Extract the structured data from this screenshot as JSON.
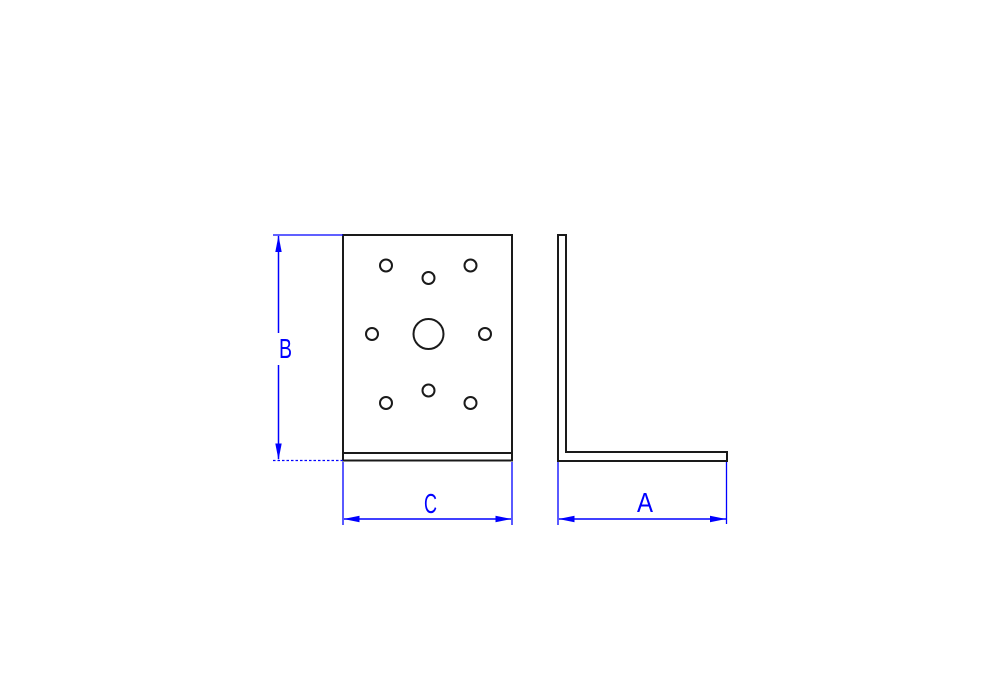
{
  "canvas": {
    "background": "#ffffff"
  },
  "drawing": {
    "geometry_color": "#1a1a1a",
    "dimension_color": "#0000ff",
    "labels": {
      "b": "B",
      "c": "C",
      "a": "A"
    },
    "front_view": {
      "small_hole_radius": 6,
      "small_holes": [
        [
          386,
          265.5
        ],
        [
          470.5,
          265.5
        ],
        [
          428.5,
          278
        ],
        [
          372,
          334
        ],
        [
          485,
          334
        ],
        [
          428.5,
          390.5
        ],
        [
          386,
          403
        ],
        [
          470.5,
          403
        ]
      ],
      "large_hole_radius": 15,
      "large_hole": [
        428.5,
        334
      ]
    }
  }
}
